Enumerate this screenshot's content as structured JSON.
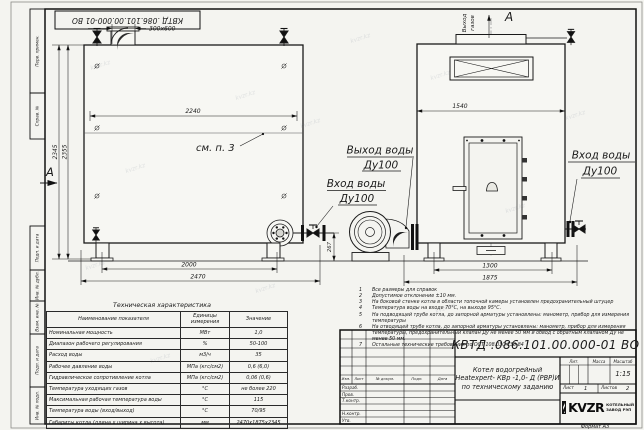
{
  "watermark": "kvzr.kz",
  "frame": {
    "top_stamp": "КВТД .086.101.00.000-01 ВО",
    "side_labels": {
      "perv": "Перв. примен.",
      "sprav": "Справ. №",
      "podp1": "Подп. и дата",
      "inv_dubl": "Инв. № дубл.",
      "vzam": "Взам. инв. №",
      "podp2": "Подп. и дата",
      "inv_podl": "Инв. № подл."
    },
    "format_note": "Формат  А3"
  },
  "side_view": {
    "duct_dim": "300х600",
    "see_note": "см. п. 3",
    "section_label": "А",
    "dim_width_top": "2240",
    "dim_height_1": "2345",
    "dim_height_2": "2355",
    "dim_base": "2000",
    "dim_overall": "2470",
    "dim_pipe_height": "267"
  },
  "front_view": {
    "gas_out_1": "Выход",
    "gas_out_2": "газов",
    "section_label": "А",
    "dim_width": "1540",
    "dim_base": "1300",
    "dim_overall": "1875"
  },
  "labels": {
    "water_out_1": "Выход воды",
    "water_out_2": "Ду100",
    "water_in_mid_1": "Вход воды",
    "water_in_mid_2": "Ду100",
    "water_in_right_1": "Вход воды",
    "water_in_right_2": "Ду100"
  },
  "notes": {
    "items": [
      {
        "num": "1",
        "text": "Все размеры для справок"
      },
      {
        "num": "2",
        "text": "Допустимое отклонение ±10 мм."
      },
      {
        "num": "3",
        "text": "На боковой стенке котла в области топочной камеры установлен предохранительный штуцер"
      },
      {
        "num": "4",
        "text": "Температура воды на входе 70°С, на выходе 95°С."
      },
      {
        "num": "5",
        "text": "На подводящей трубе котла, до запорной арматуры установлены: манометр, прибор для измерения температуры"
      },
      {
        "num": "6",
        "text": "На отводящей трубе котла, до запорной арматуры установлены: манометр, прибор для измерения температуры, предохранительный клапан Ду не менее 50 мм и обвод с обратным клапаном Ду не менее 50 мм."
      },
      {
        "num": "7",
        "text": "Остальные технические требования по ОСТ 108.030.133-84"
      }
    ]
  },
  "spec_table": {
    "title": "Техническая характеристика",
    "col_name": "Наименование показателя",
    "col_unit": "Единицы измерения",
    "col_value": "Значение",
    "rows": [
      {
        "name": "Номинальная мощность",
        "unit": "МВт",
        "value": "1,0"
      },
      {
        "name": "Диапазон рабочего регулирования",
        "unit": "%",
        "value": "50-100"
      },
      {
        "name": "Расход воды",
        "unit": "м3/ч",
        "value": "35"
      },
      {
        "name": "Рабочее давление воды",
        "unit": "МПа (кгс/см2)",
        "value": "0,6 (6,0)"
      },
      {
        "name": "Гидравлическое сопротивление котла",
        "unit": "МПа (кгс/см2)",
        "value": "0,06 (0,6)"
      },
      {
        "name": "Температура уходящих газов",
        "unit": "°С",
        "value": "не более 220"
      },
      {
        "name": "Максимальная рабочая температура воды",
        "unit": "°С",
        "value": "115"
      },
      {
        "name": "Температура воды (вход/выход)",
        "unit": "°С",
        "value": "70/95"
      },
      {
        "name": "Габариты котла (длина х ширина х высота)",
        "unit": "мм",
        "value": "2470х1875х2345"
      }
    ]
  },
  "title_block": {
    "doc_number": "КВТД .086.101.00.000-01  ВО",
    "rev_headers": {
      "izm": "Изм.",
      "list": "Лист",
      "doc": "№ докум.",
      "podp": "Подп.",
      "data": "Дата"
    },
    "sig_rows": {
      "r1": "Разраб.",
      "r2": "Пров.",
      "r3": "Т.контр.",
      "r4": "",
      "r5": "Н.контр.",
      "r6": "Утв."
    },
    "name_line1": "Котел водогрейный",
    "name_line2": "Heatexpert- КВр -1,0- Д (РВР)И",
    "name_line3": "по техническому заданию",
    "lit_label": "Лит.",
    "mass_label": "Масса",
    "scale_label": "Масштаб",
    "scale_value": "1:15",
    "sheet_label": "Лист",
    "sheet_value": "1",
    "sheets_label": "Листов",
    "sheets_value": "2",
    "logo_text": "KVZR",
    "logo_caption_1": "КОТЕЛЬНЫЙ",
    "logo_caption_2": "ЗАВОД РЭП"
  }
}
